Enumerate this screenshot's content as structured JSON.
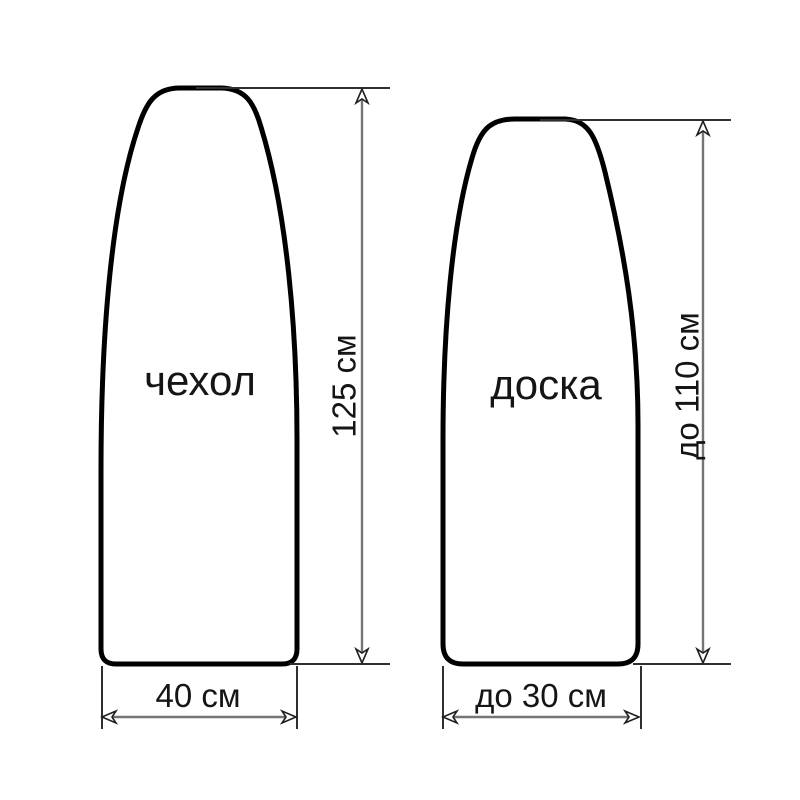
{
  "diagram": {
    "cover": {
      "label": "чехол",
      "height_label": "125 см",
      "width_label": "40 см"
    },
    "board": {
      "label": "доска",
      "height_label": "до 110 см",
      "width_label": "до 30 см"
    },
    "colors": {
      "background": "#ffffff",
      "outline": "#000000",
      "dimension_lines": "#757575",
      "extension_lines": "#2f2f2f",
      "text": "#151515"
    }
  }
}
